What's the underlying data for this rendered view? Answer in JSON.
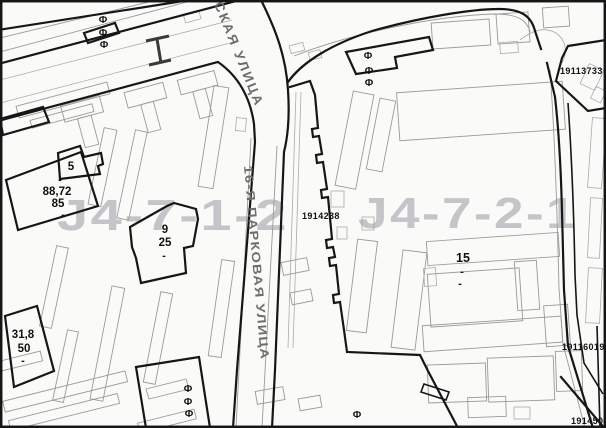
{
  "map": {
    "watermarks": {
      "left": "J4-7-1-2",
      "right": "J4-7-2-1"
    },
    "streets": {
      "top_diagonal": "СКАЯ УЛИЦА",
      "main_vertical": "16-Я ПАРКОВАЯ УЛИЦА"
    },
    "parcels": {
      "center_strip": "1914238",
      "top_right": "19113733",
      "mid_right": "19116019",
      "bottom_right": "1914504"
    },
    "buildings": {
      "b5": {
        "num": "5",
        "dash": "-"
      },
      "b88": {
        "area": "88,72",
        "num": "85",
        "dash": "-"
      },
      "b9": {
        "num": "9",
        "sub": "25",
        "dash": "-"
      },
      "b31": {
        "area": "31,8",
        "num": "50",
        "dash": "-"
      },
      "b15": {
        "num": "15",
        "dash1": "-",
        "dash2": "-"
      }
    },
    "symbols": {
      "utility_pole": "Ф"
    },
    "colors": {
      "bold_line": "#161616",
      "light_line": "#9a9a9a",
      "watermark": "#9fa0a8",
      "street_text": "#6d6d6d",
      "paper": "#fafaf8"
    }
  }
}
